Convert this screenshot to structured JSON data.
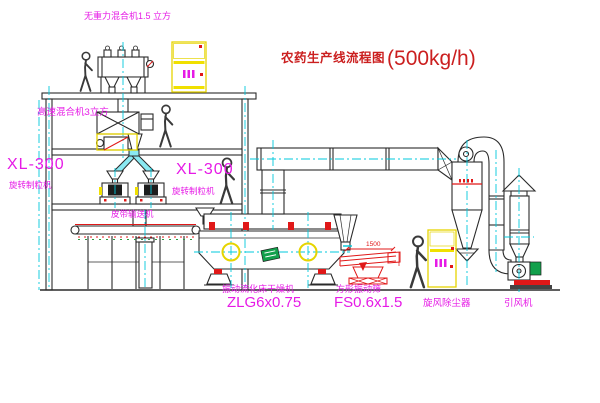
{
  "title": {
    "cn": "农药生产线流程图",
    "capacity": "(500kg/h)"
  },
  "labels": {
    "top_mixer": "无重力混合机1.5 立方",
    "hs_mixer": "高速混合机3立方",
    "xl_left_model": "XL-300",
    "xl_left_name": "旋转制粒机",
    "xl_right_model": "XL-300",
    "xl_right_name": "旋转制粒机",
    "conveyor": "皮带输送机",
    "dryer_name": "振动流化床干燥机",
    "dryer_model": "ZLG6x0.75",
    "sieve_name": "方形振动筛",
    "sieve_model": "FS0.6x1.5",
    "cyclone": "旋风除尘器",
    "fan": "引风机",
    "dim_sieve_length": "1500"
  },
  "colors": {
    "title_red": "#cb1f1f",
    "label_magenta": "#e61ae6",
    "centerline_cyan": "#00c9dc",
    "cabinet_yellow": "#f0e000",
    "equipment_black": "#2a2a2a",
    "accent_red": "#e01818",
    "logo_green": "#12a04c",
    "background": "#ffffff"
  }
}
